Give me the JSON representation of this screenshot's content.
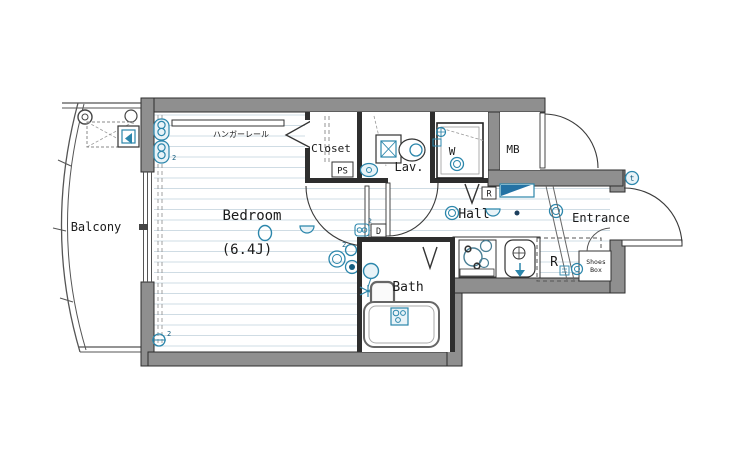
{
  "meta": {
    "type": "apartment-floor-plan"
  },
  "colors": {
    "wall": "#8f8f8f",
    "partition": "#2e2e2e",
    "fixture_blue": "#2b86ab",
    "fixture_fill": "#e8f3f8",
    "cabinet_fill": "#2472a4",
    "floor_line": "#cfdce4"
  },
  "rooms": {
    "balcony": {
      "label": "Balcony"
    },
    "bedroom": {
      "label": "Bedroom",
      "size": "(6.4J)",
      "hanger_rail": "ハンガーレール"
    },
    "closet": {
      "label": "Closet",
      "pipe_space": "PS"
    },
    "lavatory": {
      "label": "Lav."
    },
    "laundry": {
      "label": "W"
    },
    "meter_box": {
      "label": "MB"
    },
    "hall": {
      "label": "Hall",
      "return_box": "R"
    },
    "kitchen": {
      "fridge": "R",
      "door_box": "D"
    },
    "bath": {
      "label": "Bath"
    },
    "entrance": {
      "label": "Entrance",
      "shoes_box_line1": "Shoes",
      "shoes_box_line2": "Box",
      "intercom": "t"
    }
  },
  "annotations": {
    "outlet_count": "2"
  }
}
